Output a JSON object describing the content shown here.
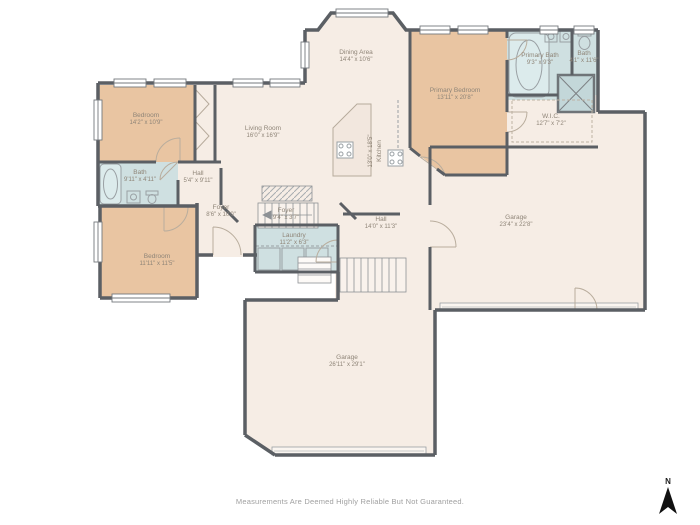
{
  "plan": {
    "disclaimer": "Measurements Are Deemed Highly Reliable But Not Guaranteed.",
    "compass": {
      "label": "N"
    }
  },
  "colors": {
    "wall": "#5b5f64",
    "room_default": "#f6ede5",
    "bedroom_fill": "#e9c5a2",
    "bath_fill": "#cfe0e1",
    "label_text": "#8f8578",
    "disclaimer_text": "#a0a0a0"
  },
  "rooms": [
    {
      "name": "Dining Area",
      "dims": "14'4\" x 10'6\""
    },
    {
      "name": "Primary Bedroom",
      "dims": "13'11\" x 20'8\""
    },
    {
      "name": "Primary Bath",
      "dims": "9'3\" x 9'3\""
    },
    {
      "name": "Bath",
      "dims": "4'1\" x 11'6\""
    },
    {
      "name": "W.I.C.",
      "dims": "12'7\" x 7'2\""
    },
    {
      "name": "Bedroom",
      "dims": "14'2\" x 10'9\""
    },
    {
      "name": "Living Room",
      "dims": "16'0\" x 16'9\""
    },
    {
      "name": "Kitchen",
      "dims": "13'0\" x 18'5\""
    },
    {
      "name": "Bath",
      "dims": "9'11\" x 4'11\""
    },
    {
      "name": "Hall",
      "dims": "5'4\" x 9'11\""
    },
    {
      "name": "Foyer",
      "dims": "8'6\" x 10'0\""
    },
    {
      "name": "Foyer",
      "dims": "9'4\" x 3'7\""
    },
    {
      "name": "Laundry",
      "dims": "11'2\" x 6'3\""
    },
    {
      "name": "Bedroom",
      "dims": "11'11\" x 11'5\""
    },
    {
      "name": "Hall",
      "dims": "14'0\" x 11'3\""
    },
    {
      "name": "Garage",
      "dims": "23'4\" x 22'8\""
    },
    {
      "name": "Garage",
      "dims": "26'11\" x 29'1\""
    }
  ]
}
